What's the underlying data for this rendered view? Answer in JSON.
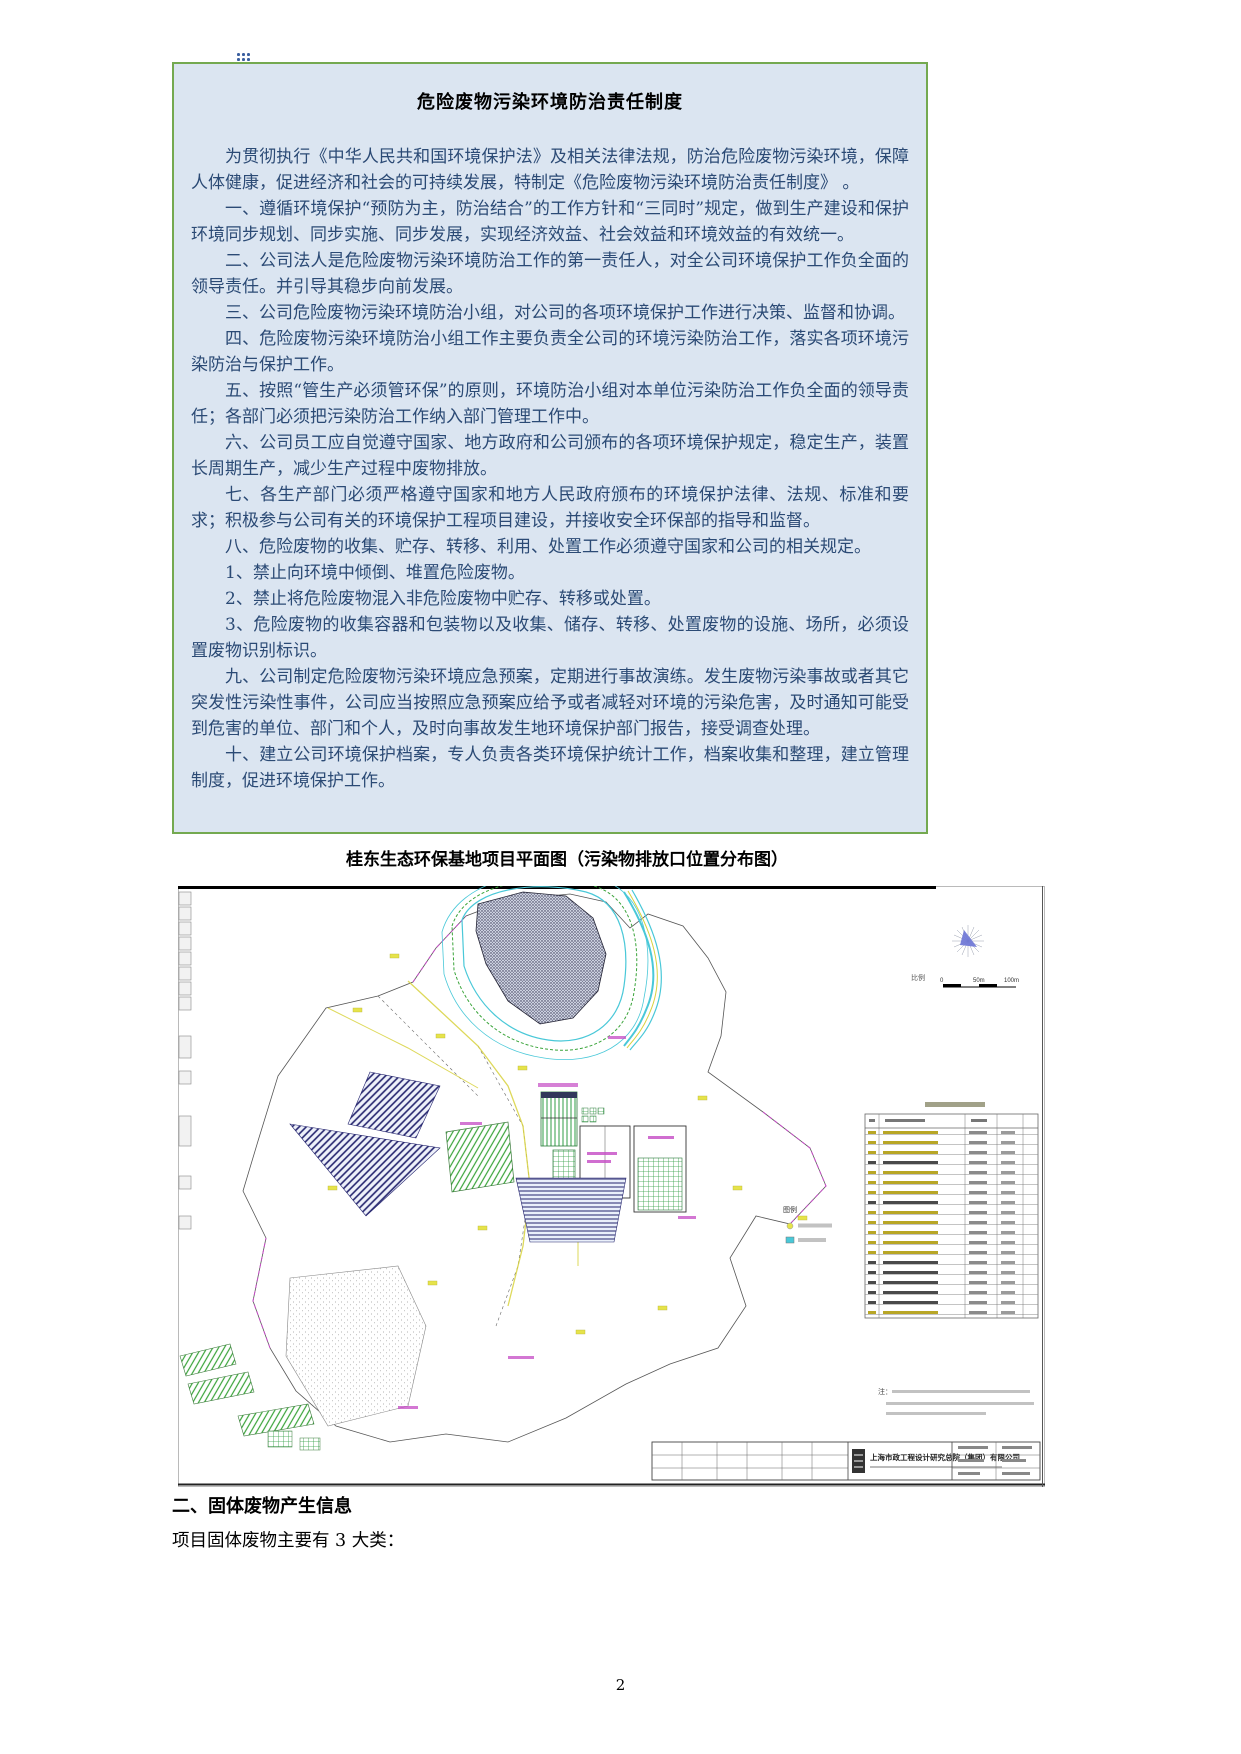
{
  "page": {
    "number": "2",
    "background": "#ffffff"
  },
  "policy_box": {
    "title": "危险废物污染环境防治责任制度",
    "border_color": "#74a950",
    "background_color": "#dbe5f1",
    "text_color": "#2b4a75",
    "paragraphs": [
      "为贯彻执行《中华人民共和国环境保护法》及相关法律法规，防治危险废物污染环境，保障人体健康，促进经济和社会的可持续发展，特制定《危险废物污染环境防治责任制度》 。",
      "一、遵循环境保护“预防为主，防治结合”的工作方针和“三同时”规定，做到生产建设和保护环境同步规划、同步实施、同步发展，实现经济效益、社会效益和环境效益的有效统一。",
      "二、公司法人是危险废物污染环境防治工作的第一责任人，对全公司环境保护工作负全面的领导责任。并引导其稳步向前发展。",
      "三、公司危险废物污染环境防治小组，对公司的各项环境保护工作进行决策、监督和协调。",
      "四、危险废物污染环境防治小组工作主要负责全公司的环境污染防治工作，落实各项环境污染防治与保护工作。",
      "五、按照“管生产必须管环保”的原则，环境防治小组对本单位污染防治工作负全面的领导责任；各部门必须把污染防治工作纳入部门管理工作中。",
      "六、公司员工应自觉遵守国家、地方政府和公司颁布的各项环境保护规定，稳定生产，装置长周期生产，减少生产过程中废物排放。",
      "七、各生产部门必须严格遵守国家和地方人民政府颁布的环境保护法律、法规、标准和要求；积极参与公司有关的环境保护工程项目建设，并接收安全环保部的指导和监督。",
      "八、危险废物的收集、贮存、转移、利用、处置工作必须遵守国家和公司的相关规定。",
      "1、禁止向环境中倾倒、堆置危险废物。",
      "2、禁止将危险废物混入非危险废物中贮存、转移或处置。",
      "3、危险废物的收集容器和包装物以及收集、储存、转移、处置废物的设施、场所，必须设置废物识别标识。",
      "九、公司制定危险废物污染环境应急预案，定期进行事故演练。发生废物污染事故或者其它突发性污染性事件，公司应当按照应急预案应给予或者减轻对环境的污染危害，及时通知可能受到危害的单位、部门和个人，及时向事故发生地环境保护部门报告，接受调查处理。",
      "十、建立公司环境保护档案，专人负责各类环境保护统计工作，档案收集和整理，建立管理制度，促进环境保护工作。"
    ]
  },
  "figure": {
    "caption": "桂东生态环保基地项目平面图（污染物排放口位置分布图）",
    "map": {
      "scale_label": "比例",
      "scale_ticks": [
        "0",
        "50m",
        "100m"
      ],
      "legend_title": "图例",
      "notes_label": "注：",
      "company": "上海市政工程设计研究总院（集团）有限公司",
      "colors": {
        "contour_cyan": "#49c8d8",
        "vegetation_green": "#2f9e44",
        "hatch_navy": "#24246e",
        "road_yellow": "#d8d23e",
        "label_magenta": "#c44ac4"
      }
    }
  },
  "section": {
    "heading": "二、固体废物产生信息",
    "body": "项目固体废物主要有 3 大类："
  }
}
